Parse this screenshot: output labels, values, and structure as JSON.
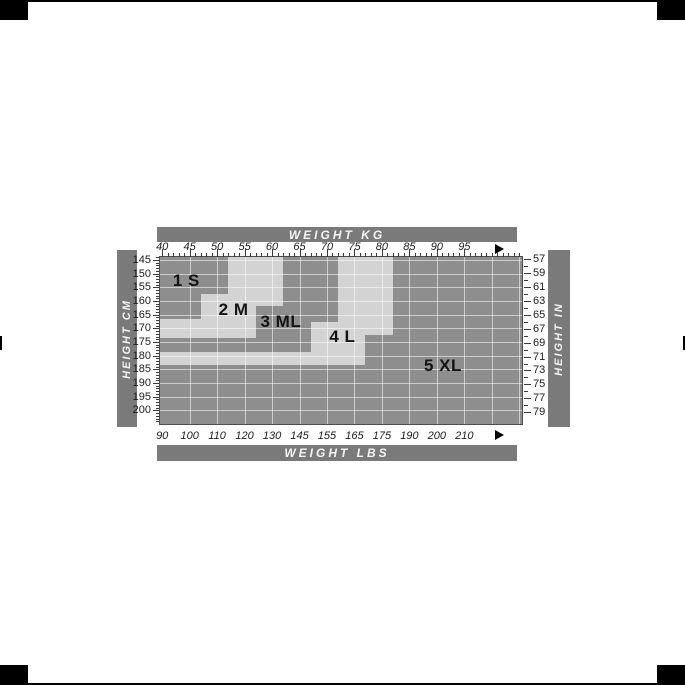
{
  "page": {
    "background_color": "#ffffff"
  },
  "frame": {
    "mark_color": "#000000"
  },
  "chart_data": {
    "type": "area",
    "title": "Size chart: body weight vs body height, regions 1 S - 5 XL",
    "axes": {
      "top": {
        "title": "WEIGHT KG",
        "unit": "kg",
        "tick_min": 40,
        "tick_max": 95,
        "tick_step": 5,
        "minor_step": 1,
        "domain_min": 39.6,
        "domain_max": 105.5,
        "overflow_arrow": true
      },
      "bottom": {
        "title": "WEIGHT LBS",
        "unit": "lbs",
        "labels": [
          "90",
          "100",
          "110",
          "120",
          "130",
          "145",
          "155",
          "165",
          "175",
          "190",
          "200",
          "210"
        ],
        "overflow_arrow": true
      },
      "left": {
        "title": "HEIGHT CM",
        "unit": "cm",
        "tick_min": 145,
        "tick_max": 200,
        "tick_step": 5,
        "minor_step": 1,
        "domain_min": 143.9,
        "domain_max": 205.0
      },
      "right": {
        "title": "HEIGHT IN",
        "unit": "in",
        "labels": [
          "57",
          "59",
          "61",
          "63",
          "65",
          "67",
          "69",
          "71",
          "73",
          "75",
          "77",
          "79"
        ]
      }
    },
    "grid": {
      "vertical_step_kg": 5,
      "horizontal_step_cm": 5
    },
    "sizes": [
      {
        "label": "1 S",
        "shade": "dark",
        "boundary_steps": [
          {
            "kg_max": 52,
            "cm_max": 157.5
          },
          {
            "kg_max": 47,
            "cm_max": 166.5
          }
        ],
        "label_at": {
          "kg": 44.4,
          "cm": 152.7
        }
      },
      {
        "label": "2 M",
        "shade": "light",
        "boundary_steps": [
          {
            "kg_max": 62,
            "cm_max": 162.0
          },
          {
            "kg_max": 57,
            "cm_max": 173.5
          }
        ],
        "label_at": {
          "kg": 53.0,
          "cm": 163.3
        }
      },
      {
        "label": "3 ML",
        "shade": "dark",
        "boundary_steps": [
          {
            "kg_max": 72,
            "cm_max": 167.5
          },
          {
            "kg_max": 67,
            "cm_max": 178.5
          }
        ],
        "label_at": {
          "kg": 61.6,
          "cm": 167.5
        }
      },
      {
        "label": "4 L",
        "shade": "light",
        "boundary_steps": [
          {
            "kg_max": 82,
            "cm_max": 172.5
          },
          {
            "kg_max": 77,
            "cm_max": 183.5
          }
        ],
        "label_at": {
          "kg": 72.8,
          "cm": 173.0
        }
      },
      {
        "label": "5 XL",
        "shade": "dark",
        "boundary_steps": [],
        "label_at": {
          "kg": 91.1,
          "cm": 183.6
        }
      }
    ],
    "colors": {
      "region_dark": "#8e8e8e",
      "region_light": "#d3d3d3",
      "grid_line": "rgba(255,255,255,0.55)",
      "header_bar": "#7a7a7a",
      "header_text": "#f4f4f4",
      "axis_text": "#1c1c1c",
      "tick": "#3a3a3a",
      "plot_border": "#4d4d4d",
      "size_label_text": "#141414",
      "arrow": "#000000"
    }
  }
}
